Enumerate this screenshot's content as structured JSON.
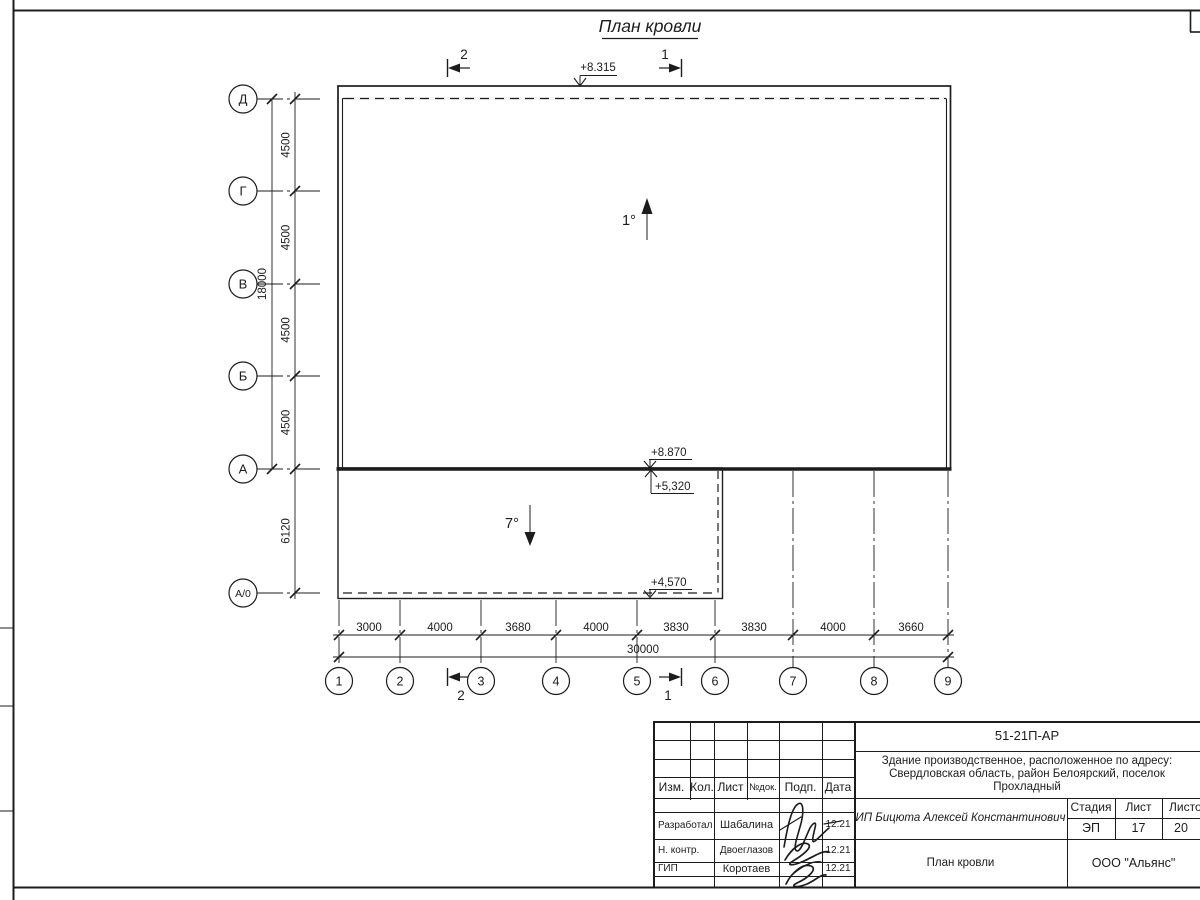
{
  "drawing": {
    "title": "План кровли",
    "section_top_left": "2",
    "section_top_right": "1",
    "section_bottom_left": "2",
    "section_bottom_right": "1",
    "elev_roof_top": "+8.315",
    "elev_main": "+8.870",
    "elev_mid": "+5,320",
    "elev_annex": "+4,570",
    "slope_main": "1°",
    "slope_annex": "7°",
    "axes_left": [
      "Д",
      "Г",
      "В",
      "Б",
      "А",
      "А/0"
    ],
    "axes_bottom": [
      "1",
      "2",
      "3",
      "4",
      "5",
      "6",
      "7",
      "8",
      "9"
    ],
    "dims_left": [
      "4500",
      "4500",
      "4500",
      "4500"
    ],
    "dim_left_total": "18000",
    "dim_annex_height": "6120",
    "dims_bottom": [
      "3000",
      "4000",
      "3680",
      "4000",
      "3830",
      "3830",
      "4000",
      "3660"
    ],
    "dim_bottom_total": "30000"
  },
  "title_block": {
    "doc_number": "51-21П-АР",
    "project_lines": [
      "Здание производственное, расположенное по адресу:",
      "Свердловская область, район Белоярский, поселок",
      "Прохладный"
    ],
    "columns": [
      "Изм.",
      "Кол.",
      "Лист",
      "№док.",
      "Подп.",
      "Дата"
    ],
    "rows": [
      {
        "role": "Разработал",
        "name": "Шабалина",
        "date": "12.21"
      },
      {
        "role": "Н. контр.",
        "name": "Двоеглазов",
        "date": "12.21"
      },
      {
        "role": "ГИП",
        "name": "Коротаев",
        "date": "12.21"
      }
    ],
    "client": "ИП Бицюта Алексей Константинович",
    "stage_label": "Стадия",
    "sheet_label": "Лист",
    "sheets_label": "Листов",
    "stage": "ЭП",
    "sheet_no": "17",
    "sheets_total": "20",
    "drawing_name": "План кровли",
    "company": "ООО \"Альянс\""
  }
}
